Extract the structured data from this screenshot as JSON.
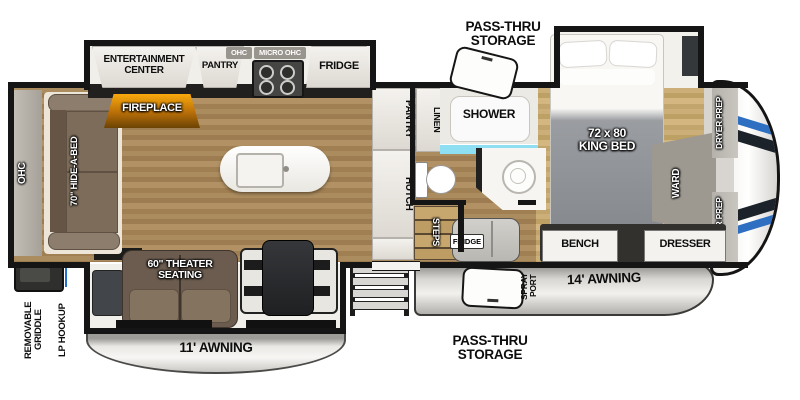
{
  "brand": "WILDCAT",
  "exterior": {
    "pass_thru_top": "PASS-THRU\nSTORAGE",
    "pass_thru_bottom": "PASS-THRU\nSTORAGE",
    "awning_rear": "11' AWNING",
    "awning_main": "14' AWNING",
    "spray_port": "SPRAY\nPORT",
    "lp_hookup": "LP HOOKUP",
    "removable_griddle": "REMOVABLE\nGRIDDLE",
    "fridge_exterior": "FRIDGE"
  },
  "kitchen": {
    "entertainment_center": "ENTERTAINMENT\nCENTER",
    "pantry": "PANTRY",
    "ohc": "OHC",
    "micro_ohc": "MICRO OHC",
    "fridge": "FRIDGE",
    "fireplace": "FIREPLACE",
    "pantry_tall": "PANTRY",
    "hutch": "HUTCH"
  },
  "living": {
    "ohc": "OHC",
    "hide_a_bed": "70\" HIDE-A-BED",
    "theater_seating": "60\" THEATER\nSEATING"
  },
  "bath": {
    "linen": "LINEN",
    "shower": "SHOWER",
    "steps": "STEPS"
  },
  "bedroom": {
    "king_bed": "72 x 80\nKING BED",
    "ward": "WARD",
    "dryer_prep": "DRYER PREP",
    "washer_prep": "WASHER PREP",
    "dresser": "DRESSER",
    "bench": "BENCH"
  },
  "colors": {
    "wall": "#151515",
    "wood_main": "#a2845a",
    "wood_bedroom": "#c7a973",
    "slide_floor": "#f1efe9",
    "sofa_brown": "#776654",
    "fireplace_orange": "#f9a90c",
    "shower_glass": "#8edff2",
    "cap_blue": "#2e6fc1",
    "clearance_orange": "#ea962c"
  }
}
